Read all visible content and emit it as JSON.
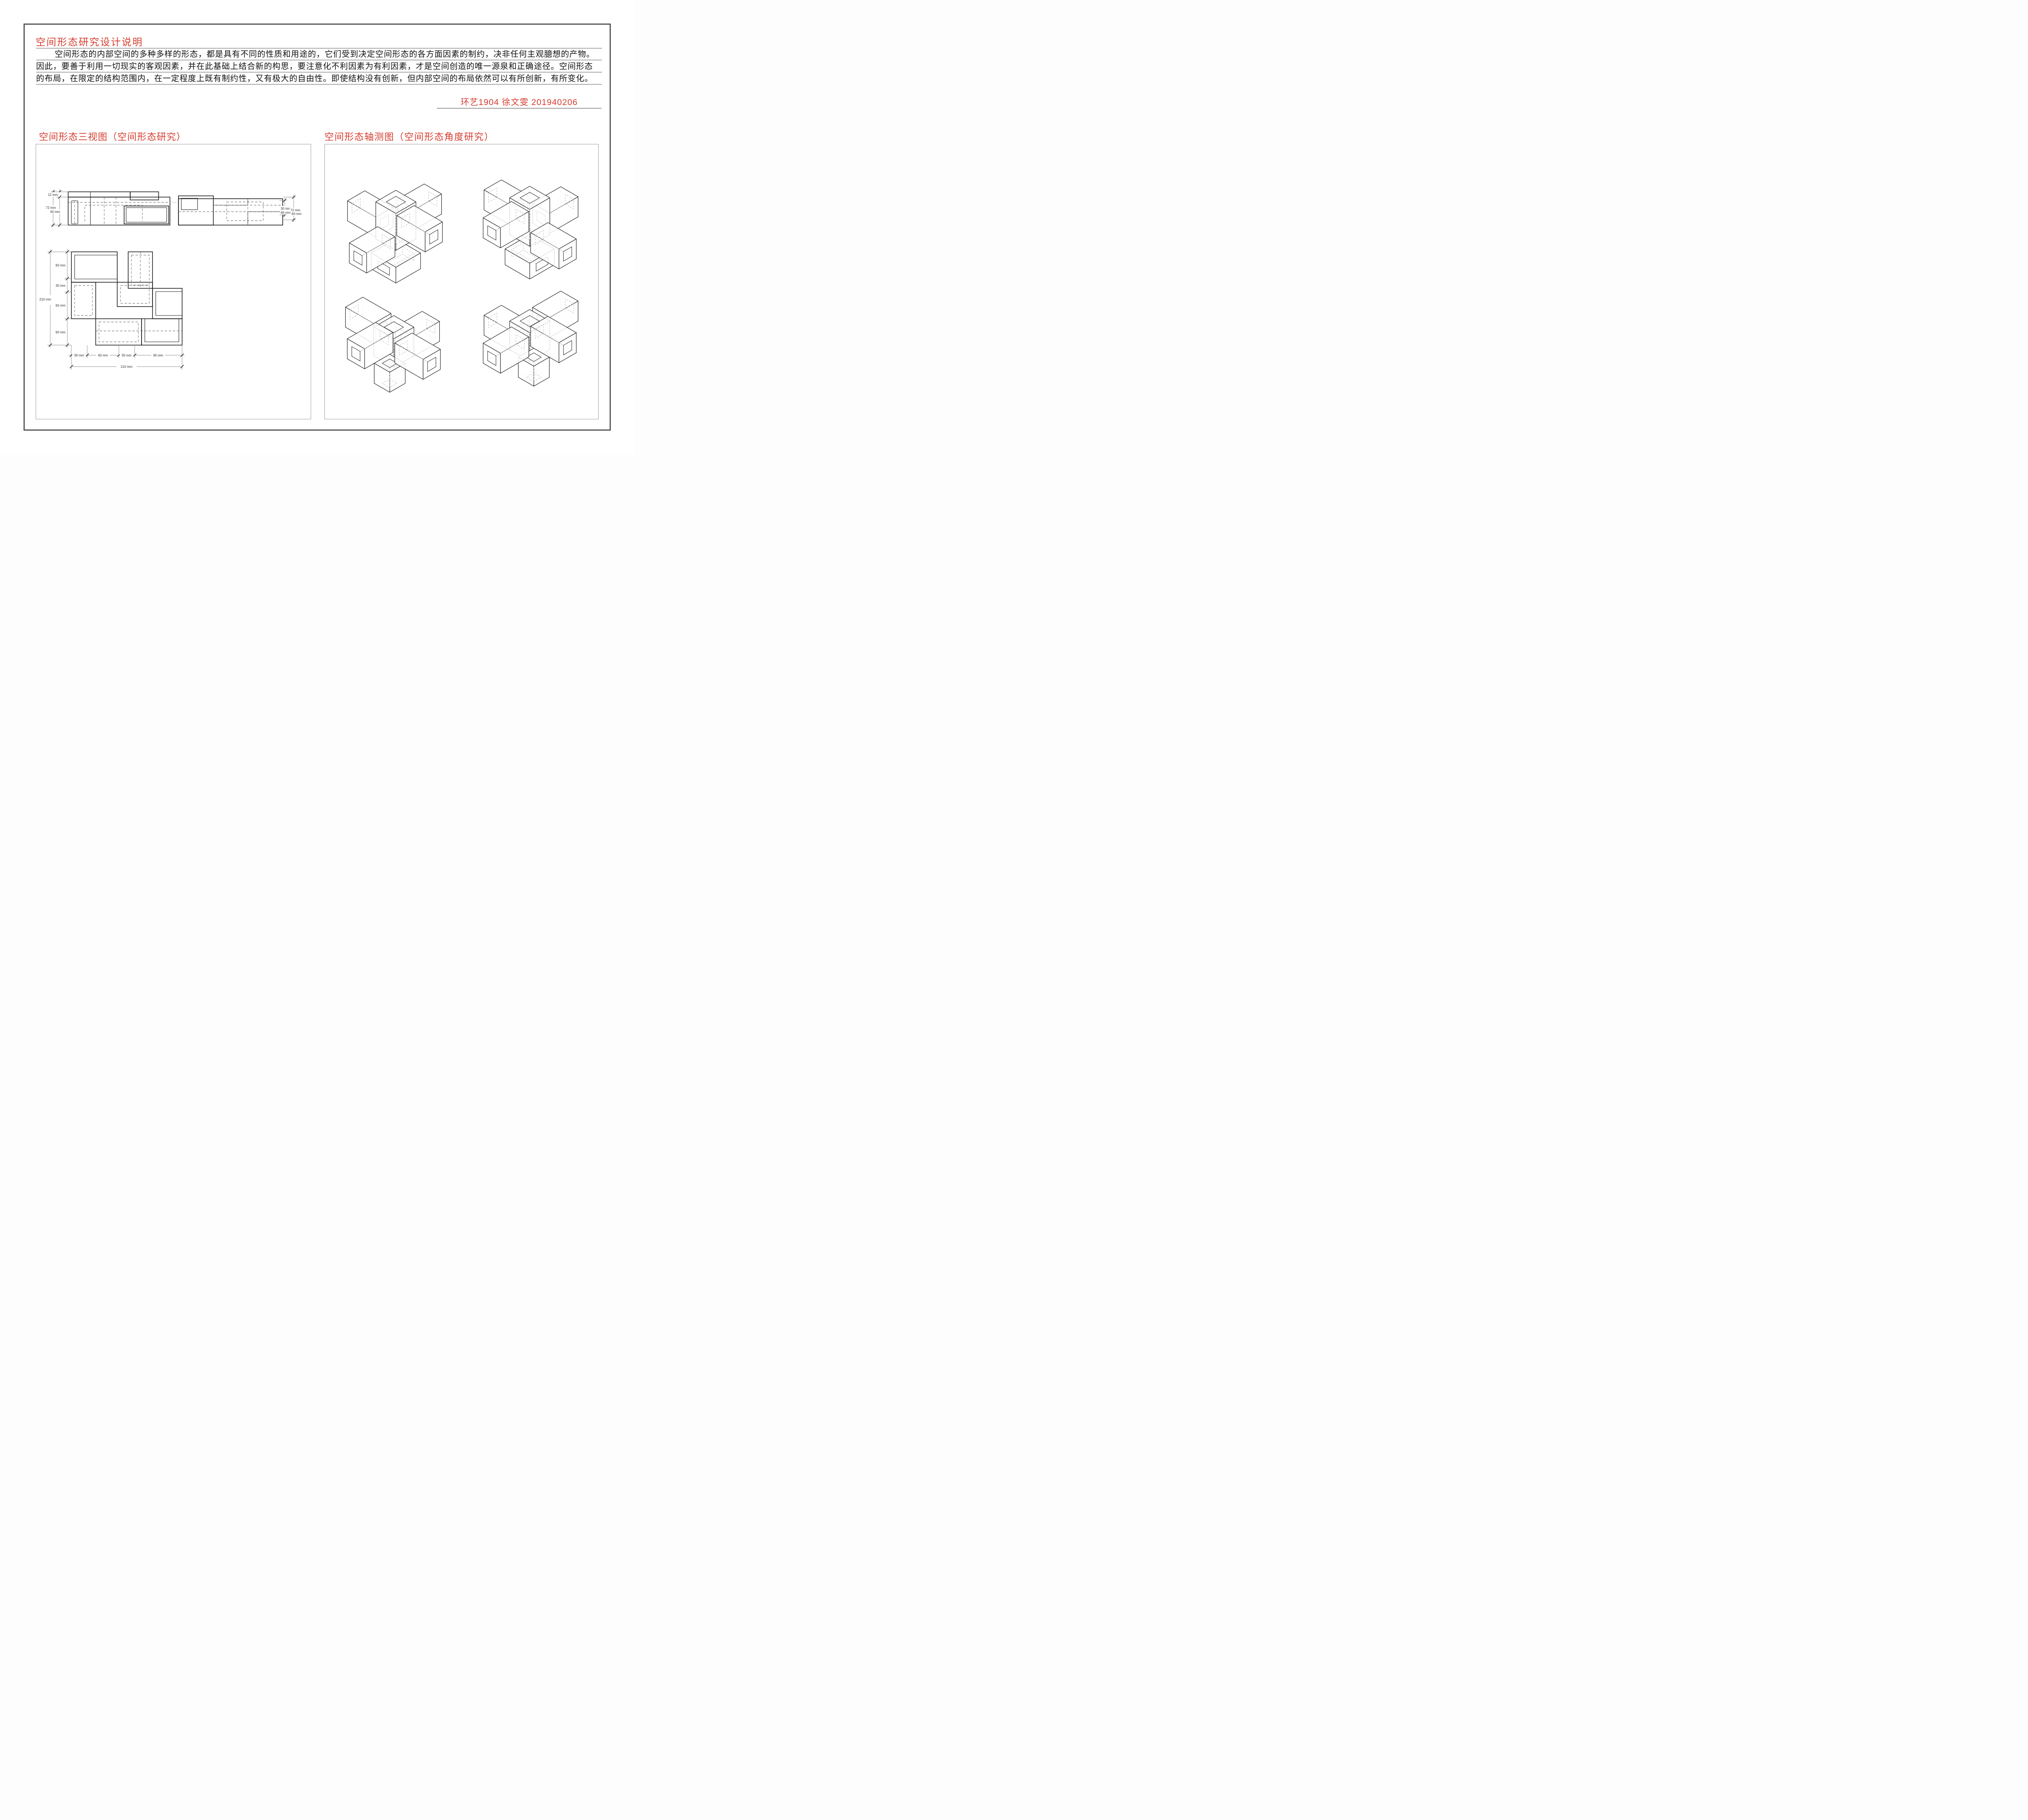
{
  "title": "空间形态研究设计说明",
  "description": {
    "line1": "空间形态的内部空间的多种多样的形态，都是具有不同的性质和用途的，它们受到决定空间形态的各方面因素的制约，决非任何主观臆想的产物。",
    "line2": "因此，要善于利用一切现实的客观因素，并在此基础上结合新的构思，要注意化不利因素为有利因素，才是空间创造的唯一源泉和正确途径。空间形态",
    "line3": "的布局，在限定的结构范围内，在一定程度上既有制约性，又有极大的自由性。即使结构没有创新，但内部空间的布局依然可以有所创新，有所变化。"
  },
  "author": "环艺1904  徐文雯  201940206",
  "sections": {
    "three_view": {
      "title": "空间形态三视图（空间形态研究）",
      "front_dims": {
        "top": "12 mm",
        "overall": "72 mm",
        "lower": "60 mm"
      },
      "side_dims": {
        "a": "30 mm",
        "b": "66 mm",
        "c": "72 mm",
        "d": "60 mm"
      },
      "plan_left_dims": [
        "60 mm",
        "30 mm",
        "210 mm",
        "60 mm",
        "60 mm"
      ],
      "plan_bottom_dims": [
        "30 mm",
        "60 mm",
        "30 mm",
        "90 mm",
        "210 mm"
      ]
    },
    "axonometric": {
      "title": "空间形态轴测图（空间形态角度研究）"
    }
  },
  "colors": {
    "accent_red": "#d63c2f",
    "frame_gray": "#585858",
    "rule_gray": "#a9a9a9",
    "panel_border_gray": "#9c9c9c",
    "drawing_black": "#1b1b1b",
    "hidden_line_gray": "#b0b0b0"
  }
}
